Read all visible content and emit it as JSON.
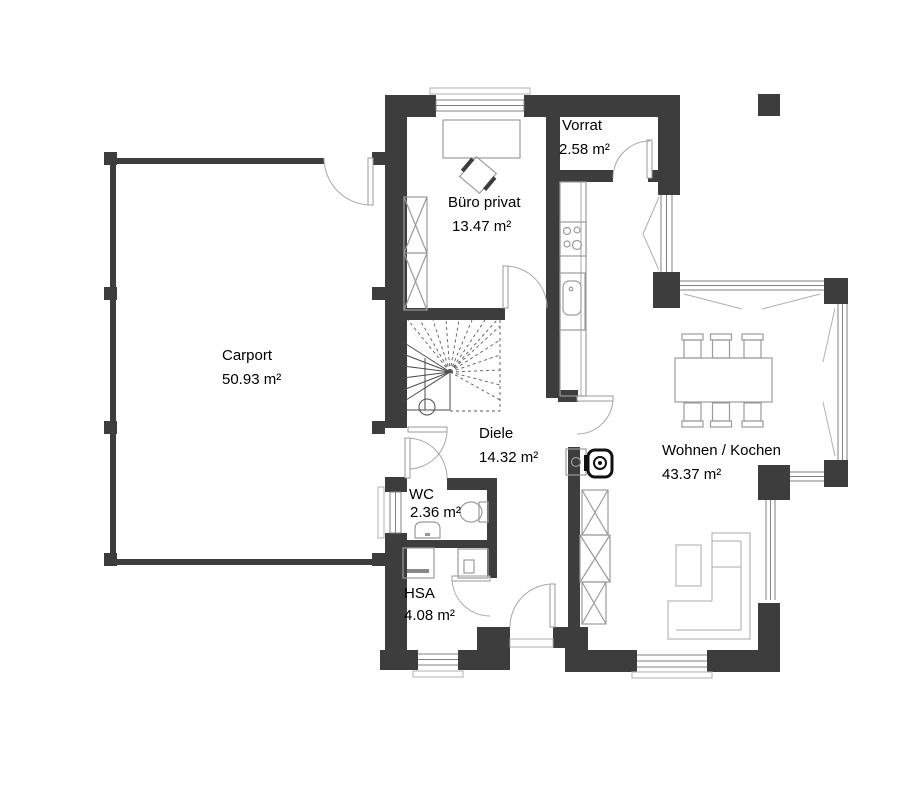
{
  "rooms": {
    "carport": {
      "name": "Carport",
      "area": "50.93 m²"
    },
    "buero": {
      "name": "Büro privat",
      "area": "13.47 m²"
    },
    "vorrat": {
      "name": "Vorrat",
      "area": "2.58 m²"
    },
    "diele": {
      "name": "Diele",
      "area": "14.32 m²"
    },
    "wc": {
      "name": "WC",
      "area": "2.36 m²"
    },
    "hsa": {
      "name": "HSA",
      "area": "4.08 m²"
    },
    "wohnen": {
      "name": "Wohnen / Kochen",
      "area": "43.37 m²"
    }
  },
  "colors": {
    "wall": "#3d3d3d",
    "background": "#ffffff",
    "furniture_line": "#9b9b9b",
    "door_line": "#999999",
    "window_line": "#808080",
    "stair_line": "#4a4a4a",
    "text": "#000000"
  }
}
